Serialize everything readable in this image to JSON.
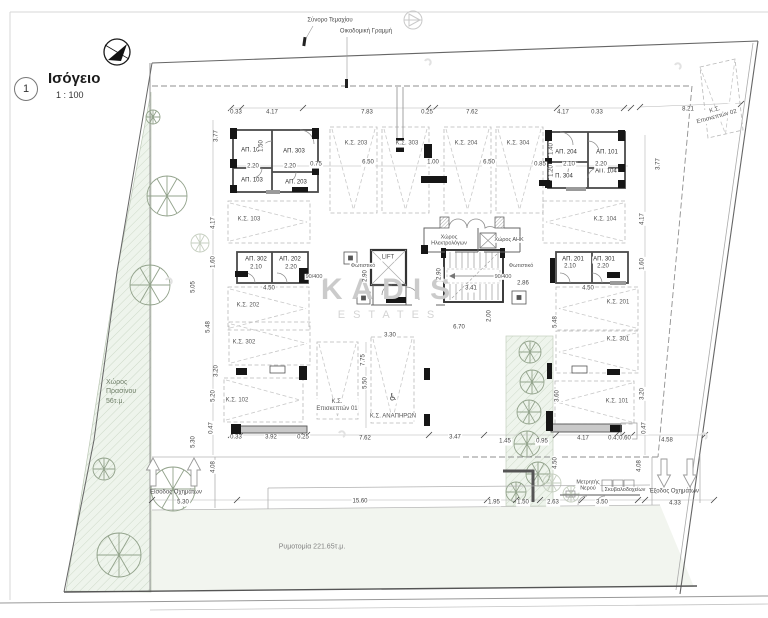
{
  "title": {
    "number": "1",
    "name": "Ισόγειο",
    "scale": "1 : 100"
  },
  "site": {
    "plot_boundary_label": "Σύνορο Τεμαχίου",
    "building_line_label": "Οικοδομική Γραμμή",
    "green_space_label": "Χώρος\nΠρασίνου\n56τ.μ.",
    "street_widening_label": "Ρυμοτομία 221.65τ.μ.",
    "vehicle_entrance_label": "Είσοδος Οχημάτων",
    "vehicle_exit_label": "Έξοδος Οχημάτων",
    "water_meter_label": "Μετρητής\nΝερού",
    "bins_label": "Σκυβαλοδοχείων"
  },
  "core": {
    "lift": "LIFT",
    "electrical_room": "Χώρος\nΗλεκτρολόγων",
    "utility_room": "Χώρος ΑΗΚ",
    "light_fixture": "Φωτιστικό"
  },
  "watermark": {
    "line1": "KADIS",
    "line2": "ESTATES"
  },
  "icons": {
    "wheelchair": "♿"
  },
  "colors": {
    "green_area": "#eef4ec",
    "street_area": "#f2f5ef",
    "walls": "#4a4a4a",
    "watermark": "#cbcbcb"
  },
  "storage_rooms": [
    {
      "id": "ap-102",
      "label": "ΑΠ. 102",
      "x": 252,
      "y": 151
    },
    {
      "id": "ap-303",
      "label": "ΑΠ. 303",
      "x": 294,
      "y": 152
    },
    {
      "id": "ap-103",
      "label": "ΑΠ. 103",
      "x": 252,
      "y": 181
    },
    {
      "id": "ap-203",
      "label": "ΑΠ. 203",
      "x": 296,
      "y": 183
    },
    {
      "id": "ap-204",
      "label": "ΑΠ. 204",
      "x": 566,
      "y": 153
    },
    {
      "id": "ap-101",
      "label": "ΑΠ. 101",
      "x": 607,
      "y": 153
    },
    {
      "id": "ap-304",
      "label": "ΑΠ. 304",
      "x": 562,
      "y": 177
    },
    {
      "id": "ap-104",
      "label": "ΑΠ. 104",
      "x": 606,
      "y": 172
    },
    {
      "id": "ap-302",
      "label": "ΑΠ. 302",
      "x": 256,
      "y": 260
    },
    {
      "id": "ap-202",
      "label": "ΑΠ. 202",
      "x": 290,
      "y": 260
    },
    {
      "id": "ap-201",
      "label": "ΑΠ. 201",
      "x": 573,
      "y": 260
    },
    {
      "id": "ap-301",
      "label": "ΑΠ. 301",
      "x": 604,
      "y": 260
    }
  ],
  "parking_spaces": [
    {
      "id": "ks-203",
      "label": "Κ.Σ. 203",
      "lx": 356,
      "ly": 144,
      "rx": 330,
      "ry": 127,
      "rw": 47,
      "rh": 86,
      "dir": "down"
    },
    {
      "id": "ks-303",
      "label": "Κ.Σ. 303",
      "lx": 407,
      "ly": 144,
      "rx": 382,
      "ry": 127,
      "rw": 47,
      "rh": 86,
      "dir": "down"
    },
    {
      "id": "ks-204",
      "label": "Κ.Σ. 204",
      "lx": 466,
      "ly": 144,
      "rx": 444,
      "ry": 127,
      "rw": 47,
      "rh": 86,
      "dir": "down"
    },
    {
      "id": "ks-304",
      "label": "Κ.Σ. 304",
      "lx": 518,
      "ly": 144,
      "rx": 496,
      "ry": 127,
      "rw": 47,
      "rh": 86,
      "dir": "down"
    },
    {
      "id": "ks-103",
      "label": "Κ.Σ. 103",
      "lx": 249,
      "ly": 220,
      "rx": 228,
      "ry": 201,
      "rw": 82,
      "rh": 42,
      "dir": "right"
    },
    {
      "id": "ks-104",
      "label": "Κ.Σ. 104",
      "lx": 605,
      "ly": 220,
      "rx": 543,
      "ry": 201,
      "rw": 82,
      "rh": 42,
      "dir": "left"
    },
    {
      "id": "ks-202",
      "label": "Κ.Σ. 202",
      "lx": 248,
      "ly": 306,
      "rx": 228,
      "ry": 287,
      "rw": 81,
      "rh": 43,
      "dir": "right"
    },
    {
      "id": "ks-201",
      "label": "Κ.Σ. 201",
      "lx": 618,
      "ly": 303,
      "rx": 556,
      "ry": 287,
      "rw": 82,
      "rh": 43,
      "dir": "left"
    },
    {
      "id": "ks-302",
      "label": "Κ.Σ. 302",
      "lx": 244,
      "ly": 343,
      "rx": 229,
      "ry": 322,
      "rw": 81,
      "rh": 43,
      "dir": "right"
    },
    {
      "id": "ks-301",
      "label": "Κ.Σ. 301",
      "lx": 618,
      "ly": 340,
      "rx": 556,
      "ry": 331,
      "rw": 82,
      "rh": 42,
      "dir": "left"
    },
    {
      "id": "ks-102",
      "label": "Κ.Σ. 102",
      "lx": 237,
      "ly": 401,
      "rx": 224,
      "ry": 378,
      "rw": 79,
      "rh": 44,
      "dir": "right"
    },
    {
      "id": "ks-101",
      "label": "Κ.Σ. 101",
      "lx": 617,
      "ly": 402,
      "rx": 555,
      "ry": 381,
      "rw": 79,
      "rh": 43,
      "dir": "left"
    },
    {
      "id": "ks-visitor-01",
      "label": "Κ.Σ.\nΕπισκεπτών 01",
      "lx": 337,
      "ly": 406,
      "rx": 317,
      "ry": 342,
      "rw": 41,
      "rh": 77,
      "dir": "down"
    },
    {
      "id": "ks-disabled",
      "label": "Κ.Σ. ΑΝΑΠΗΡΩΝ",
      "lx": 393,
      "ly": 417,
      "rx": 371,
      "ry": 337,
      "rw": 43,
      "rh": 86,
      "dir": "down"
    },
    {
      "id": "ks-visitor-02",
      "label": "Κ.Σ.\nΕπισκεπτών 02",
      "lx": 716,
      "ly": 114,
      "rot": -15,
      "poly": "700,67 735,59 743,130 708,138"
    }
  ],
  "notes": [
    {
      "t": "Φωτιστικό",
      "x": 363,
      "y": 266
    },
    {
      "t": "Φωτιστικό",
      "x": 521,
      "y": 266
    },
    {
      "t": "90/400",
      "x": 314,
      "y": 277
    },
    {
      "t": "90/400",
      "x": 503,
      "y": 277
    }
  ],
  "dimensions": [
    {
      "t": "0.33",
      "x": 236,
      "y": 113
    },
    {
      "t": "4.17",
      "x": 272,
      "y": 113
    },
    {
      "t": "7.83",
      "x": 367,
      "y": 113
    },
    {
      "t": "0.25",
      "x": 427,
      "y": 113
    },
    {
      "t": "7.62",
      "x": 472,
      "y": 113
    },
    {
      "t": "4.17",
      "x": 563,
      "y": 113
    },
    {
      "t": "0.33",
      "x": 597,
      "y": 113
    },
    {
      "t": "8.21",
      "x": 688,
      "y": 110
    },
    {
      "t": "2.20",
      "x": 253,
      "y": 167
    },
    {
      "t": "2.20",
      "x": 290,
      "y": 167
    },
    {
      "t": "0.75",
      "x": 316,
      "y": 165
    },
    {
      "t": "1.50",
      "x": 262,
      "y": 146,
      "v": 1
    },
    {
      "t": "0.85",
      "x": 540,
      "y": 165
    },
    {
      "t": "2.10",
      "x": 569,
      "y": 165
    },
    {
      "t": "2.20",
      "x": 601,
      "y": 165
    },
    {
      "t": "1.40",
      "x": 552,
      "y": 149,
      "v": 1
    },
    {
      "t": "1.20",
      "x": 552,
      "y": 171,
      "v": 1
    },
    {
      "t": "6.50",
      "x": 368,
      "y": 163
    },
    {
      "t": "1.00",
      "x": 433,
      "y": 163
    },
    {
      "t": "6.50",
      "x": 489,
      "y": 163
    },
    {
      "t": "3.77",
      "x": 217,
      "y": 136,
      "v": 1
    },
    {
      "t": "4.17",
      "x": 214,
      "y": 223,
      "v": 1
    },
    {
      "t": "1.60",
      "x": 214,
      "y": 262,
      "v": 1
    },
    {
      "t": "5.48",
      "x": 209,
      "y": 327,
      "v": 1
    },
    {
      "t": "3.20",
      "x": 217,
      "y": 371,
      "v": 1
    },
    {
      "t": "5.20",
      "x": 214,
      "y": 396,
      "v": 1
    },
    {
      "t": "0.47",
      "x": 212,
      "y": 428,
      "v": 1
    },
    {
      "t": "5.05",
      "x": 194,
      "y": 287,
      "v": 1
    },
    {
      "t": "5.30",
      "x": 194,
      "y": 442,
      "v": 1
    },
    {
      "t": "3.77",
      "x": 659,
      "y": 164,
      "v": 1
    },
    {
      "t": "4.17",
      "x": 643,
      "y": 219,
      "v": 1
    },
    {
      "t": "1.60",
      "x": 643,
      "y": 264,
      "v": 1
    },
    {
      "t": "3.60",
      "x": 558,
      "y": 396,
      "v": 1
    },
    {
      "t": "3.20",
      "x": 643,
      "y": 394,
      "v": 1
    },
    {
      "t": "0.47",
      "x": 645,
      "y": 428,
      "v": 1
    },
    {
      "t": "2.10",
      "x": 256,
      "y": 268
    },
    {
      "t": "2.20",
      "x": 291,
      "y": 268
    },
    {
      "t": "4.50",
      "x": 269,
      "y": 289
    },
    {
      "t": "2.10",
      "x": 570,
      "y": 267
    },
    {
      "t": "2.20",
      "x": 603,
      "y": 267
    },
    {
      "t": "4.50",
      "x": 588,
      "y": 289
    },
    {
      "t": "2.90",
      "x": 366,
      "y": 276,
      "v": 1
    },
    {
      "t": "2.90",
      "x": 440,
      "y": 274,
      "v": 1
    },
    {
      "t": "3.41",
      "x": 471,
      "y": 289
    },
    {
      "t": "6.70",
      "x": 459,
      "y": 328
    },
    {
      "t": "2.86",
      "x": 523,
      "y": 284
    },
    {
      "t": "2.00",
      "x": 490,
      "y": 316,
      "v": 1
    },
    {
      "t": "5.48",
      "x": 556,
      "y": 322,
      "v": 1
    },
    {
      "t": "3.30",
      "x": 390,
      "y": 336
    },
    {
      "t": "7.75",
      "x": 364,
      "y": 360,
      "v": 1
    },
    {
      "t": "5.50",
      "x": 366,
      "y": 383,
      "v": 1
    },
    {
      "t": "0.33",
      "x": 236,
      "y": 438
    },
    {
      "t": "3.92",
      "x": 271,
      "y": 438
    },
    {
      "t": "0.25",
      "x": 303,
      "y": 438
    },
    {
      "t": "7.62",
      "x": 365,
      "y": 439
    },
    {
      "t": "3.47",
      "x": 455,
      "y": 438
    },
    {
      "t": "1.45",
      "x": 505,
      "y": 442
    },
    {
      "t": "0.95",
      "x": 542,
      "y": 442
    },
    {
      "t": "4.17",
      "x": 583,
      "y": 439
    },
    {
      "t": "0.41",
      "x": 614,
      "y": 439
    },
    {
      "t": "0.60",
      "x": 625,
      "y": 439
    },
    {
      "t": "4.58",
      "x": 667,
      "y": 441
    },
    {
      "t": "5.30",
      "x": 183,
      "y": 503
    },
    {
      "t": "15.60",
      "x": 360,
      "y": 502
    },
    {
      "t": "1.95",
      "x": 494,
      "y": 503
    },
    {
      "t": "1.50",
      "x": 523,
      "y": 503
    },
    {
      "t": "2.63",
      "x": 553,
      "y": 503
    },
    {
      "t": "3.50",
      "x": 602,
      "y": 503
    },
    {
      "t": "4.33",
      "x": 675,
      "y": 504
    },
    {
      "t": "4.08",
      "x": 214,
      "y": 467,
      "v": 1
    },
    {
      "t": "4.50",
      "x": 556,
      "y": 463,
      "v": 1
    },
    {
      "t": "4.08",
      "x": 640,
      "y": 466,
      "v": 1
    }
  ]
}
